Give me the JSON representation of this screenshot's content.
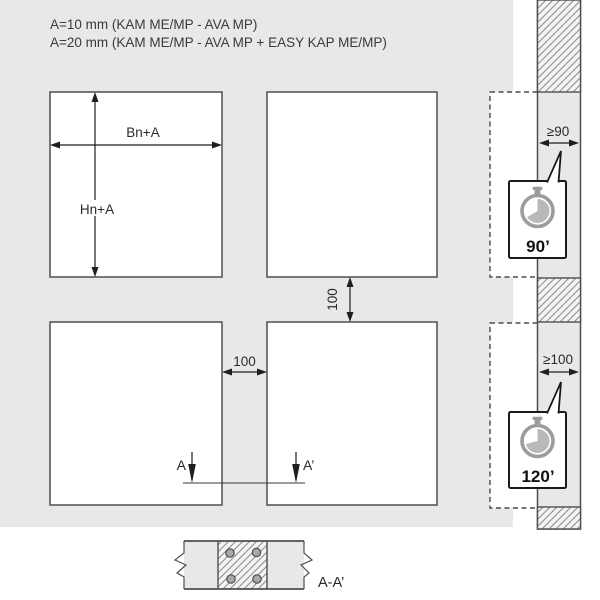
{
  "header": {
    "line1": "A=10 mm (KAM ME/MP - AVA MP)",
    "line2": "A=20 mm (KAM ME/MP - AVA MP + EASY KAP ME/MP)"
  },
  "panels": {
    "width_label": "Bn+A",
    "height_label": "Hn+A",
    "vertical_gap": "100",
    "horizontal_gap": "100"
  },
  "wall": {
    "clearance_top": "≥90",
    "clearance_bottom": "≥100",
    "rating_top": {
      "icon": "stopwatch-icon",
      "minutes": "90’"
    },
    "rating_bottom": {
      "icon": "stopwatch-icon",
      "minutes": "120’"
    }
  },
  "section": {
    "marker_left": "A",
    "marker_right": "A’",
    "view_label": "A-A’"
  },
  "colors": {
    "background": "#e8e8e8",
    "panel": "#ffffff",
    "outline": "#4f4f4f",
    "dimension": "#1f1f1f",
    "text": "#3a3a3a",
    "timer_ring": "#9c9c9c",
    "timer_sector": "#b9b9b9",
    "hatch_line": "#8f8f8f"
  }
}
